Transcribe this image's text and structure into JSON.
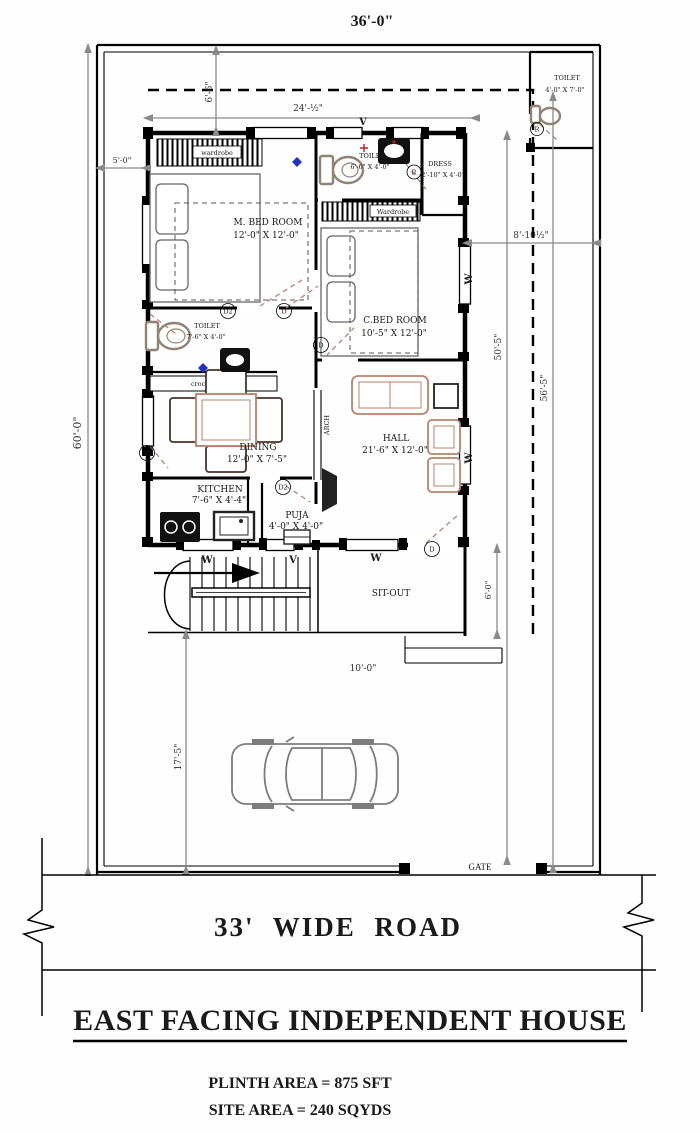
{
  "dims": {
    "top_overall": "36'-0\"",
    "inner_width": "24'-½\"",
    "top_setback": "6'-6\"",
    "left_setback": "5'-0\"",
    "site_depth": "60'-0\"",
    "side_offset": "8'-10½\"",
    "depth_a": "50'-5\"",
    "depth_b": "56'-5\"",
    "front_setback": "17'-5\"",
    "sitout_width": "10'-0\"",
    "sitout_depth": "6'-0\""
  },
  "rooms": {
    "mbed": {
      "name": "M. BED ROOM",
      "size": "12'-0\" X 12'-0\""
    },
    "cbed": {
      "name": "C.BED ROOM",
      "size": "10'-5\" X 12'-0\""
    },
    "hall": {
      "name": "HALL",
      "size": "21'-6\" X 12'-0\""
    },
    "dining": {
      "name": "DINING",
      "size": "12'-0\" X 7'-5\""
    },
    "kitchen": {
      "name": "KITCHEN",
      "size": "7'-6\" X 4'-4\""
    },
    "puja": {
      "name": "PUJA",
      "size": "4'-0\" X 4'-0\""
    },
    "toilet_attached": {
      "name": "TOILET",
      "size": "6'-6\" X 4'-0\""
    },
    "toilet_common": {
      "name": "TOILET",
      "size": "7'-6\" X 4'-0\""
    },
    "toilet_outdoor": {
      "name": "TOILET",
      "size": "4'-0\" X 7'-0\""
    },
    "dress": {
      "name": "DRESS",
      "size": "2'-10\" X 4'-0\""
    },
    "sitout": {
      "name": "SIT-OUT"
    }
  },
  "features": {
    "wardrobe_mbed": "wardrobe",
    "wardrobe_cbed": "Wardrobe",
    "crockery_unit": "crockery unit",
    "arch": "ARCH"
  },
  "tags": {
    "window": "W",
    "vent": "V",
    "door": "D",
    "door2": "D2",
    "rotary": "R",
    "arch_tag": "AR"
  },
  "road": {
    "label": "33' WIDE ROAD",
    "gate": "GATE"
  },
  "titleblock": {
    "title": "EAST FACING INDEPENDENT HOUSE",
    "plinth": "PLINTH AREA =  875 SFT",
    "site": "SITE AREA =  240 SQYDS"
  },
  "colors": {
    "wall": "#000000",
    "dim_line": "#8a8a8a",
    "furniture_tan": "#b5826b",
    "drain_blue": "#2233bb",
    "fixture_red": "#bb2222",
    "car_gray": "#7d7d7d"
  }
}
